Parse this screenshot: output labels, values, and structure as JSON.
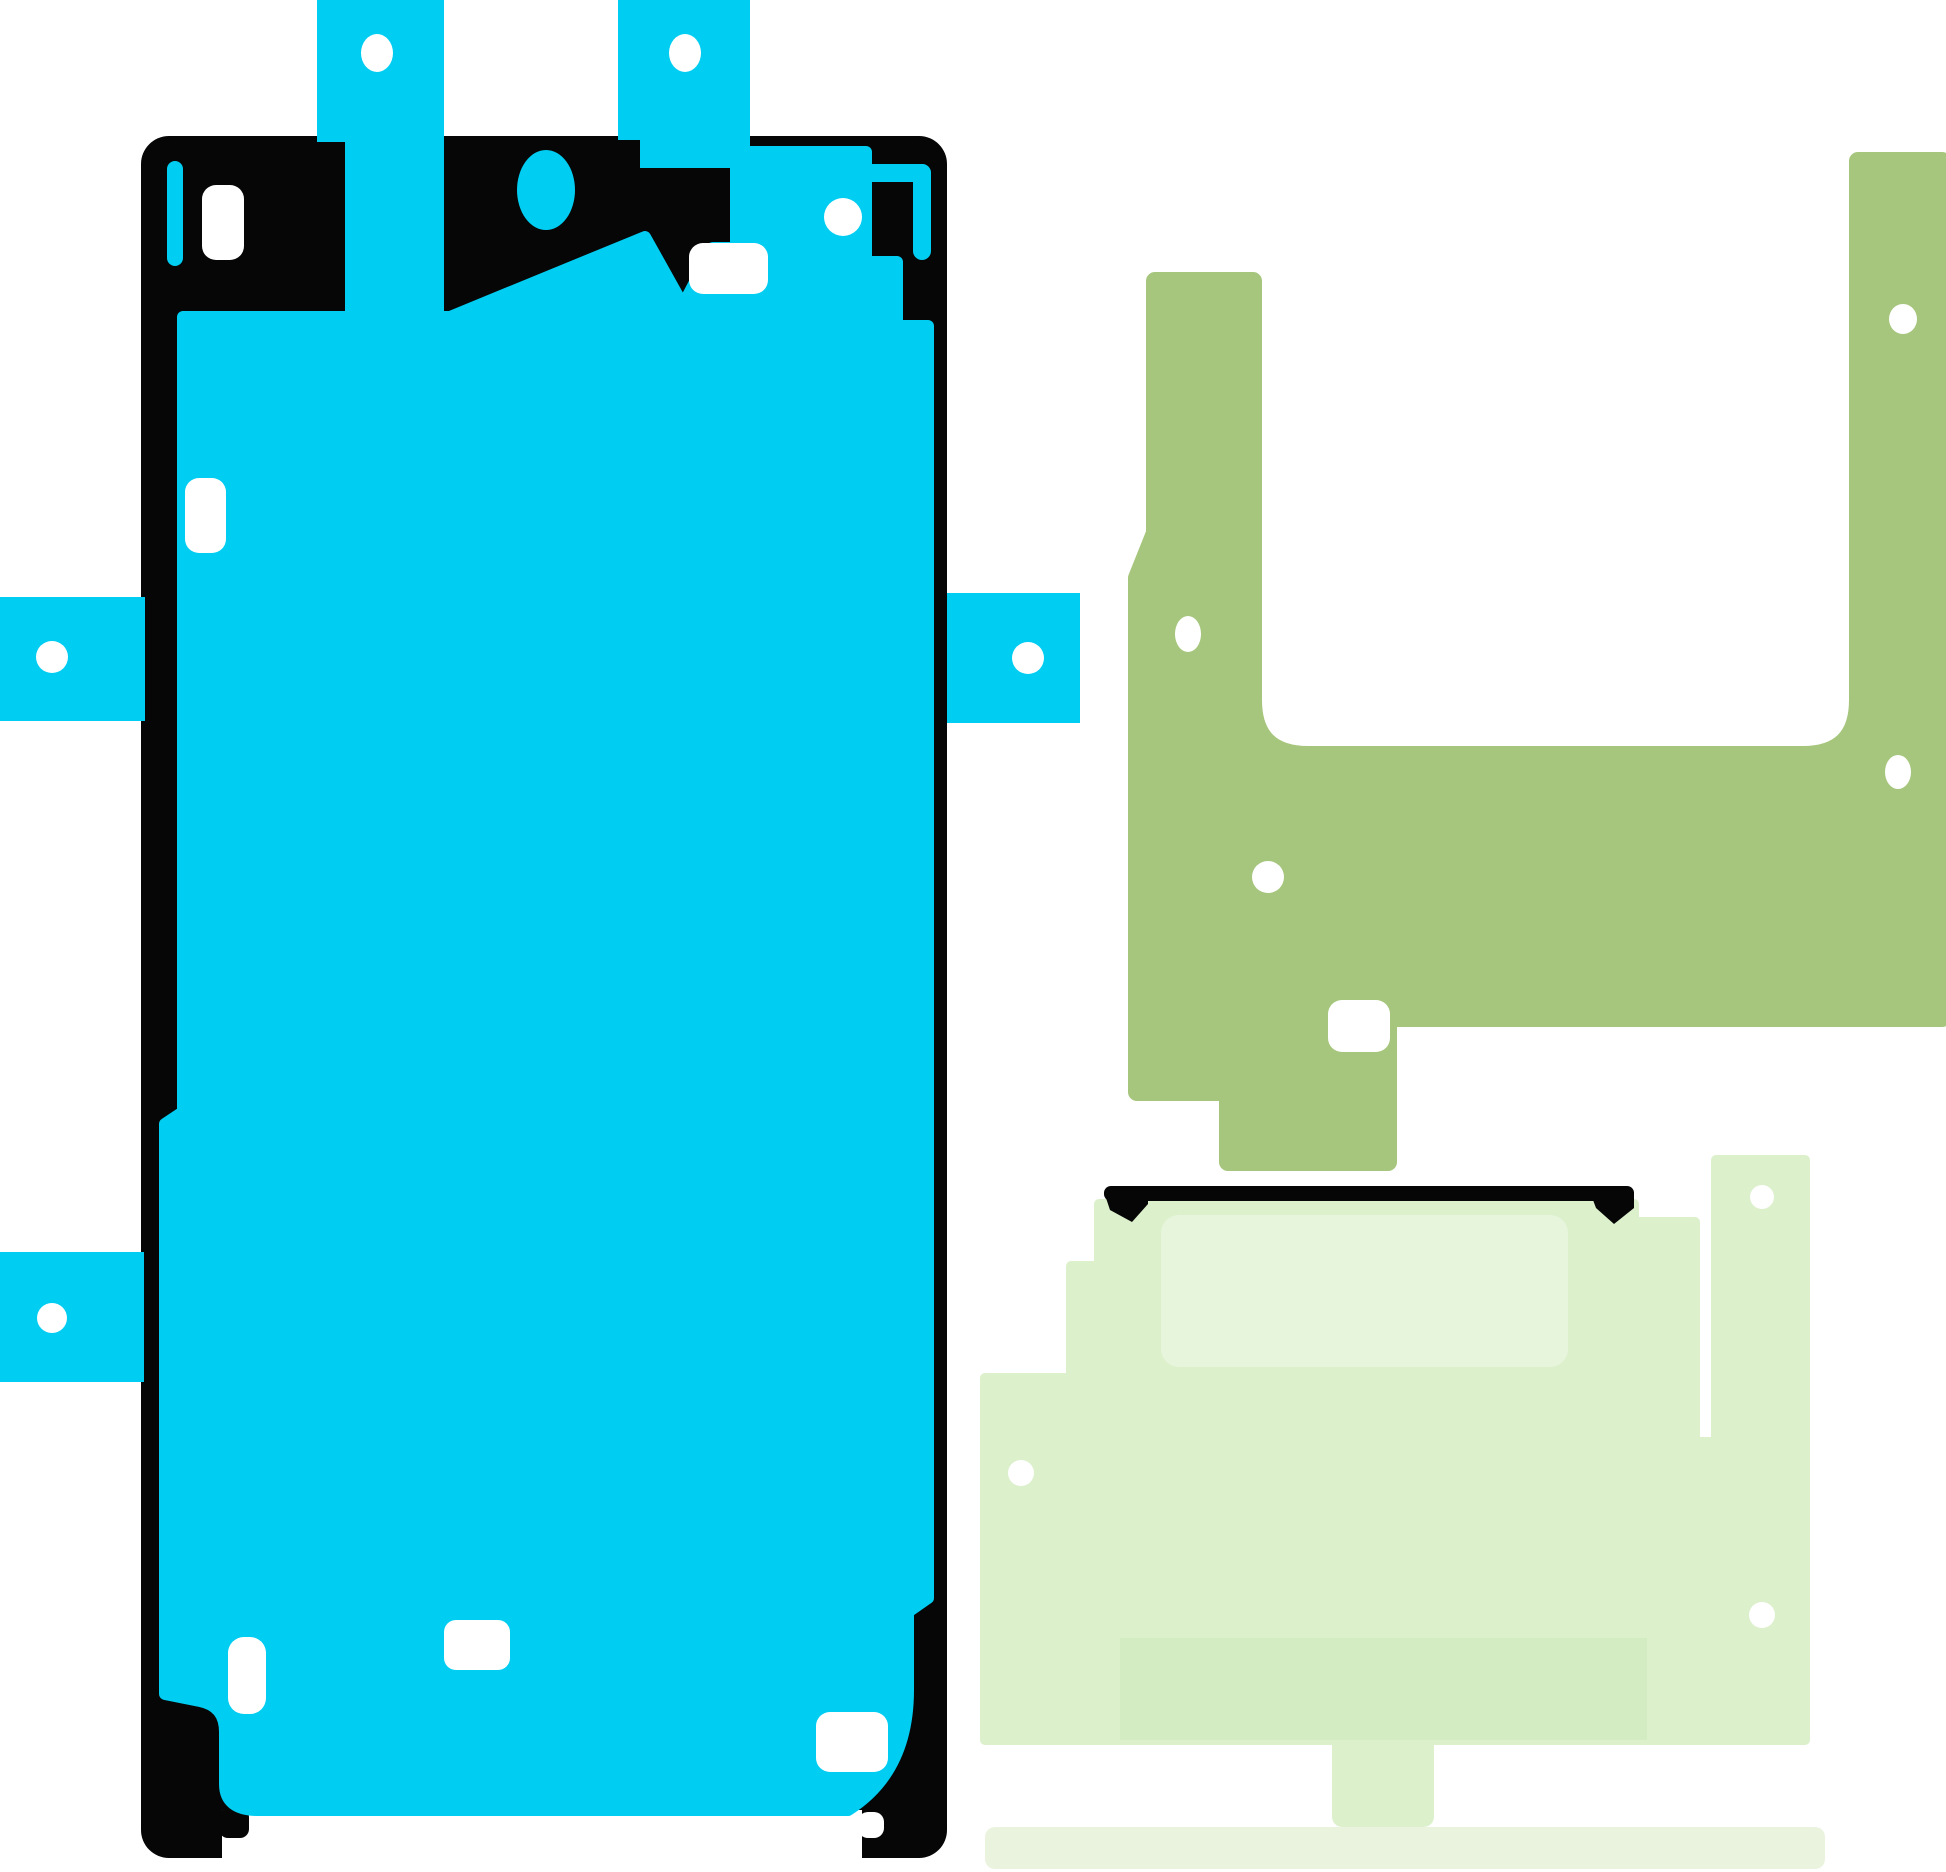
{
  "scene": {
    "description": "Product image: smartphone display adhesive sticker rework set on white background",
    "background_color": "#ffffff"
  },
  "colors": {
    "background": "#ffffff",
    "white": "#ffffff",
    "cyan": "#00cdf2",
    "black": "#060606",
    "olive": "#a6c67d",
    "green_base": "#dcf0cc",
    "green_light": "#e7f5dc",
    "green_dark": "#d3ecc2",
    "green_strip": "#e9f3de"
  },
  "pieces": {
    "screen_adhesive": {
      "id": "screen-adhesive-sticker",
      "pull_tabs": 5,
      "tab_holes": 5,
      "pin_holes": 1,
      "slot_cutouts": 6,
      "camera_cutouts": 1
    },
    "frame_adhesive": {
      "id": "frame-adhesive-sticker",
      "holes": 4,
      "notches": 1
    },
    "rework_adhesive": {
      "id": "rework-adhesive-sticker",
      "holes": 3,
      "gasket_edge": 1
    },
    "liner_strip": {
      "id": "liner-strip"
    }
  }
}
